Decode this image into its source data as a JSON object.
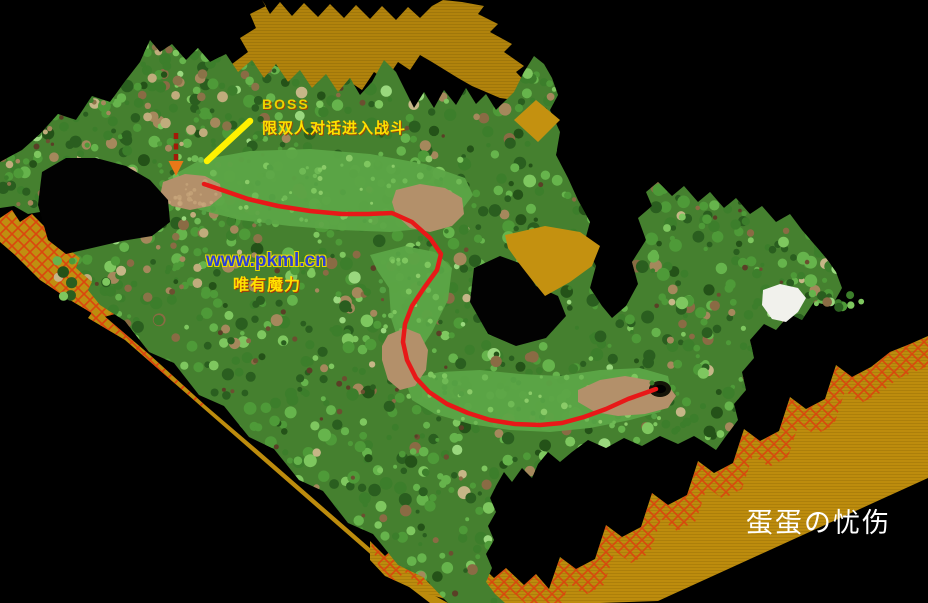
{
  "canvas": {
    "width": 928,
    "height": 603,
    "background": "#000000"
  },
  "map": {
    "description": "isometric forest game map with red route leading to a cave and a BOSS spot",
    "colors": {
      "background": "#000000",
      "cliff_top": "#B1830C",
      "cliff_left": "#C08E10",
      "cliff_se": "#BD8C0D",
      "cliff_accent": "#C49110",
      "lattice_red": "#DF3A0E",
      "forest_base": "#45802F",
      "meadow_green": "#5CA546",
      "dirt_tan": "#B3906A",
      "white_patch": "#F1F1EC",
      "cave_dark": "#141408",
      "route_red": "#E81818"
    }
  },
  "annotations": {
    "boss_label": {
      "text": "BOSS",
      "color": "#EDD400",
      "x": 262,
      "y": 97
    },
    "boss_condition": {
      "text": "限双人对话进入战斗",
      "color": "#FFE000",
      "x": 262,
      "y": 121
    },
    "site_url": {
      "text": "www.pkml.cn",
      "color": "#2B3FD6",
      "outline": "#E8D800",
      "x": 206,
      "y": 251
    },
    "site_slogan": {
      "text": "唯有魔力",
      "color": "#FFE000",
      "x": 233,
      "y": 278
    },
    "watermark": {
      "text": "蛋蛋の忧伤",
      "color": "#FFFFFF",
      "x": 746,
      "y": 510
    }
  },
  "route": {
    "color": "#E81818",
    "points": [
      [
        204,
        184
      ],
      [
        222,
        190
      ],
      [
        248,
        199
      ],
      [
        278,
        206
      ],
      [
        310,
        211
      ],
      [
        342,
        214
      ],
      [
        368,
        214
      ],
      [
        392,
        213
      ],
      [
        412,
        222
      ],
      [
        430,
        238
      ],
      [
        441,
        254
      ],
      [
        437,
        270
      ],
      [
        424,
        288
      ],
      [
        412,
        306
      ],
      [
        405,
        324
      ],
      [
        403,
        342
      ],
      [
        407,
        360
      ],
      [
        416,
        378
      ],
      [
        429,
        392
      ],
      [
        447,
        404
      ],
      [
        468,
        413
      ],
      [
        490,
        420
      ],
      [
        515,
        424
      ],
      [
        540,
        425
      ],
      [
        562,
        423
      ],
      [
        584,
        417
      ],
      [
        606,
        409
      ],
      [
        628,
        399
      ],
      [
        645,
        393
      ],
      [
        656,
        389
      ]
    ],
    "end_cave": {
      "x": 660,
      "y": 389
    }
  },
  "markers": {
    "boss_arrow_yellow": {
      "from": [
        250,
        121
      ],
      "to": [
        207,
        161
      ],
      "color": "#FFF200"
    },
    "boss_arrow_dashed": {
      "x": 176,
      "from_y": 133,
      "to_y": 160,
      "head_tip_y": 176,
      "color": "#A31A08",
      "head_color": "#E87818"
    }
  }
}
